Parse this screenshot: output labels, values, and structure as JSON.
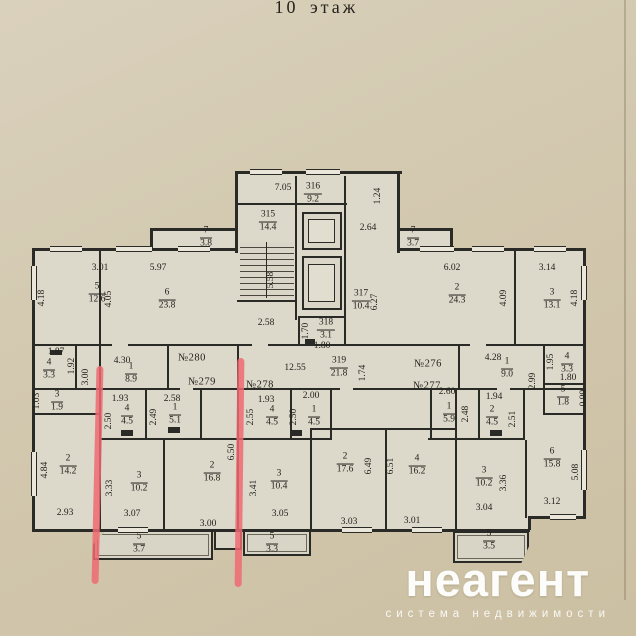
{
  "title": "10 этаж",
  "watermark": {
    "brand": "неагент",
    "tagline": "система недвижимости"
  },
  "colors": {
    "paper": "#d3c9b0",
    "plan_fill": "#dcd8ca",
    "wall": "#2a2a26",
    "highlight": "#ee6a72",
    "watermark_text": "#fcfcfa"
  },
  "plan": {
    "units": {
      "u280": "№280",
      "u279": "№279",
      "u278": "№278",
      "u276": "№276",
      "u277": "№277"
    },
    "rooms": {
      "f316": {
        "n": "316",
        "d": "9.2"
      },
      "f315": {
        "n": "315",
        "d": "14.4"
      },
      "f317": {
        "n": "317",
        "d": "10.4"
      },
      "f318": {
        "n": "318",
        "d": "3.1"
      },
      "f319": {
        "n": "319",
        "d": "21.8"
      },
      "f7l": {
        "n": "7",
        "d": "3.8"
      },
      "f7r": {
        "n": "7",
        "d": "3.7"
      },
      "f5": {
        "n": "5",
        "d": "12.6"
      },
      "f6": {
        "n": "6",
        "d": "23.8"
      },
      "f2r": {
        "n": "2",
        "d": "24.3"
      },
      "f3r": {
        "n": "3",
        "d": "13.1"
      },
      "f4l": {
        "n": "4",
        "d": "3.3"
      },
      "f1l": {
        "n": "1",
        "d": "8.9"
      },
      "f1r": {
        "n": "1",
        "d": "9.0"
      },
      "f4r": {
        "n": "4",
        "d": "3.3"
      },
      "f5r": {
        "n": "5",
        "d": "1.8"
      },
      "f3s": {
        "n": "3",
        "d": "1.9"
      },
      "f4s": {
        "n": "4",
        "d": "4.5"
      },
      "f1s": {
        "n": "1",
        "d": "5.1"
      },
      "f4c": {
        "n": "4",
        "d": "4.5"
      },
      "f1c": {
        "n": "1",
        "d": "4.5"
      },
      "f1d": {
        "n": "1",
        "d": "5.9"
      },
      "f2d": {
        "n": "2",
        "d": "4.5"
      },
      "f214": {
        "n": "2",
        "d": "14.2"
      },
      "f310": {
        "n": "3",
        "d": "10.2"
      },
      "f216": {
        "n": "2",
        "d": "16.8"
      },
      "f537": {
        "n": "5",
        "d": "3.7"
      },
      "f3104": {
        "n": "3",
        "d": "10.4"
      },
      "f533": {
        "n": "5",
        "d": "3.3"
      },
      "f2176": {
        "n": "2",
        "d": "17.6"
      },
      "f4162": {
        "n": "4",
        "d": "16.2"
      },
      "f3102": {
        "n": "3",
        "d": "10.2"
      },
      "f535": {
        "n": "5",
        "d": "3.5"
      },
      "f6158": {
        "n": "6",
        "d": "15.8"
      }
    },
    "dims": {
      "t705": "7.05",
      "v124": "1.24",
      "t264": "2.64",
      "v627": "6.27",
      "v558": "5.58",
      "t258s": "2.58",
      "v170": "1.70",
      "t180c": "1.80",
      "t301": "3.01",
      "t597": "5.97",
      "v418l": "4.18",
      "v405": "4.05",
      "t602": "6.02",
      "t314": "3.14",
      "v409": "4.09",
      "v418r": "4.18",
      "t187": "1.87",
      "v192": "1.92",
      "v300l": "3.00",
      "t430": "4.30",
      "t1255": "12.55",
      "v174": "1.74",
      "t428": "4.28",
      "v195": "1.95",
      "t180r": "1.80",
      "v299": "2.99",
      "v099": "0.99",
      "v103": "1.03",
      "t193l": "1.93",
      "v250l": "2.50",
      "v249": "2.49",
      "t258l": "2.58",
      "t193c": "1.93",
      "t200": "2.00",
      "v255": "2.55",
      "v250c": "2.50",
      "t260": "2.60",
      "v248": "2.48",
      "t194": "1.94",
      "v251": "2.51",
      "v484": "4.84",
      "t293": "2.93",
      "v333": "3.33",
      "t307": "3.07",
      "v650": "6.50",
      "t300b": "3.00",
      "v341": "3.41",
      "t305": "3.05",
      "v649": "6.49",
      "t303": "3.03",
      "v651": "6.51",
      "t301b": "3.01",
      "v336": "3.36",
      "t304": "3.04",
      "v508": "5.08",
      "t312": "3.12"
    }
  }
}
